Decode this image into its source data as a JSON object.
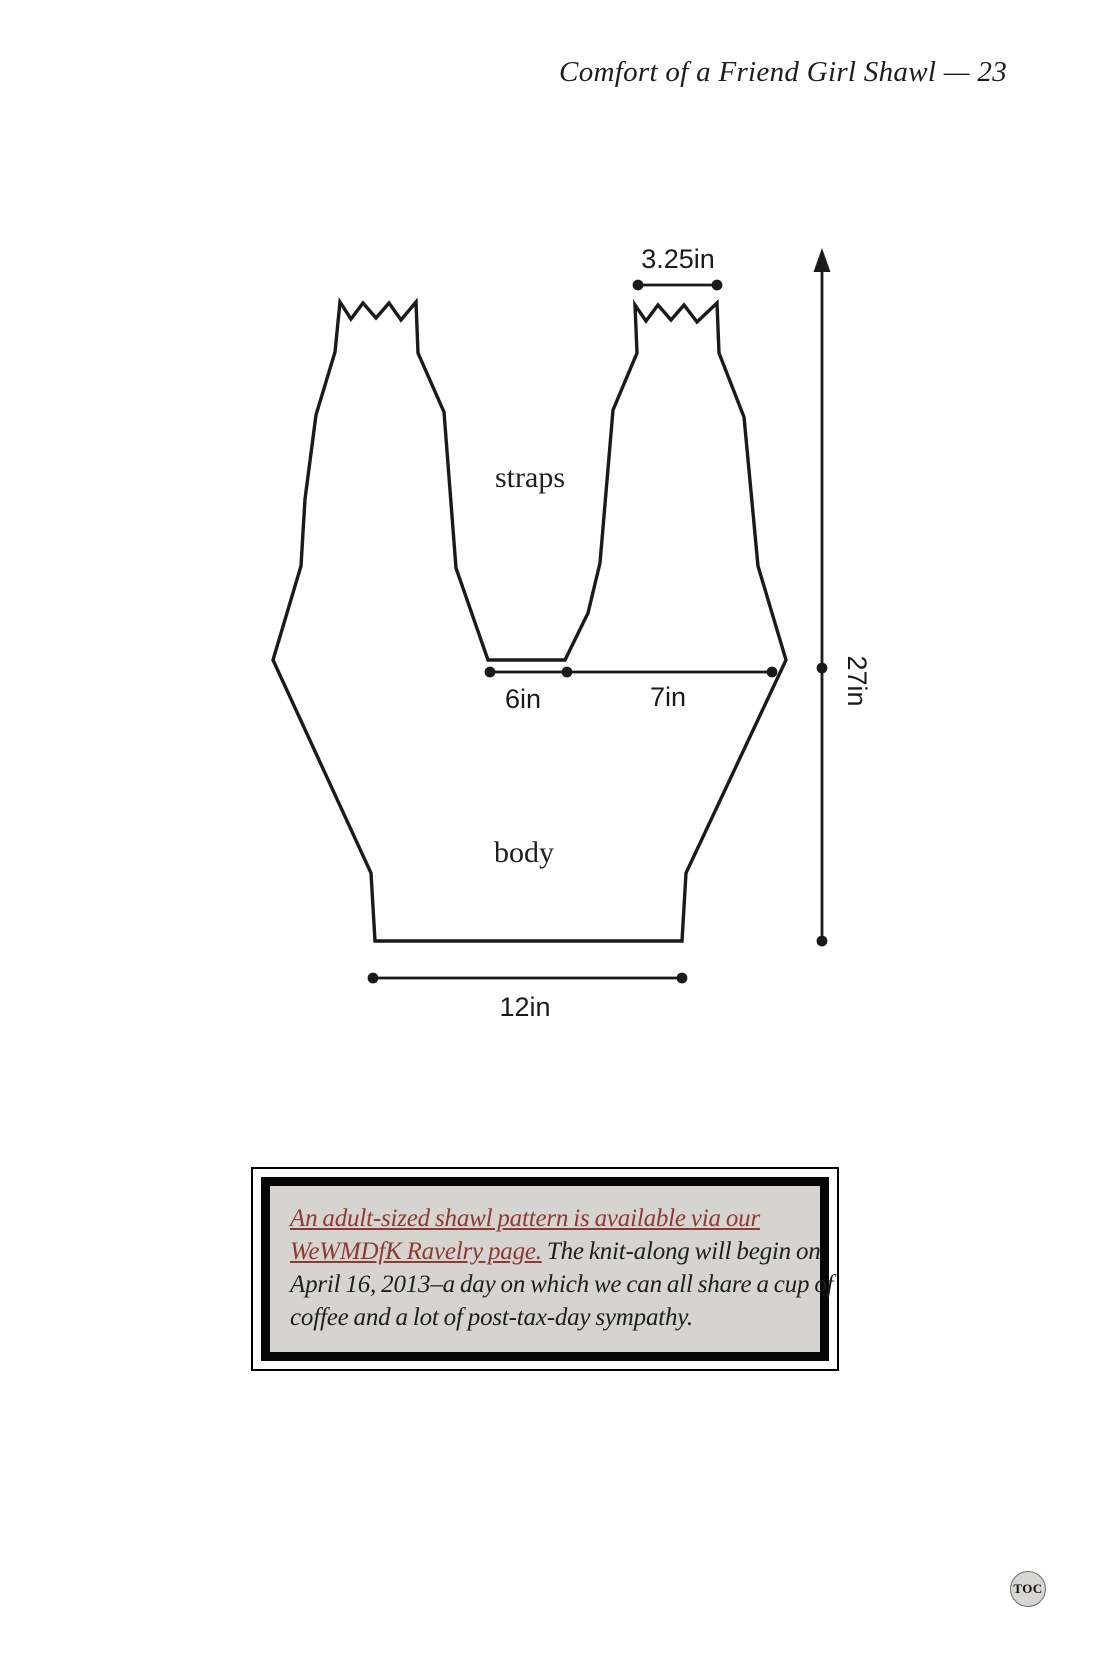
{
  "header": {
    "title": "Comfort of a Friend Girl Shawl — 23"
  },
  "schematic": {
    "straps_label": "straps",
    "body_label": "body",
    "dims": {
      "strap_top": "3.25in",
      "gap": "6in",
      "side": "7in",
      "height": "27in",
      "bottom": "12in"
    }
  },
  "note": {
    "link_line1": "An adult-sized shawl pattern is available via our",
    "link_line2": "WeWMDfK Ravelry page.",
    "text_line2": " The knit-along will begin on",
    "text_line3": "April 16, 2013–a day on which we can all share a cup of",
    "text_line4": "coffee and a lot of post-tax-day sympathy."
  },
  "footer": {
    "toc": "TOC"
  },
  "colors": {
    "ink": "#1a1a1a",
    "link_red": "#8e3a31",
    "note_background": "#d6d4d1",
    "toc_background": "#d8d6d3"
  }
}
